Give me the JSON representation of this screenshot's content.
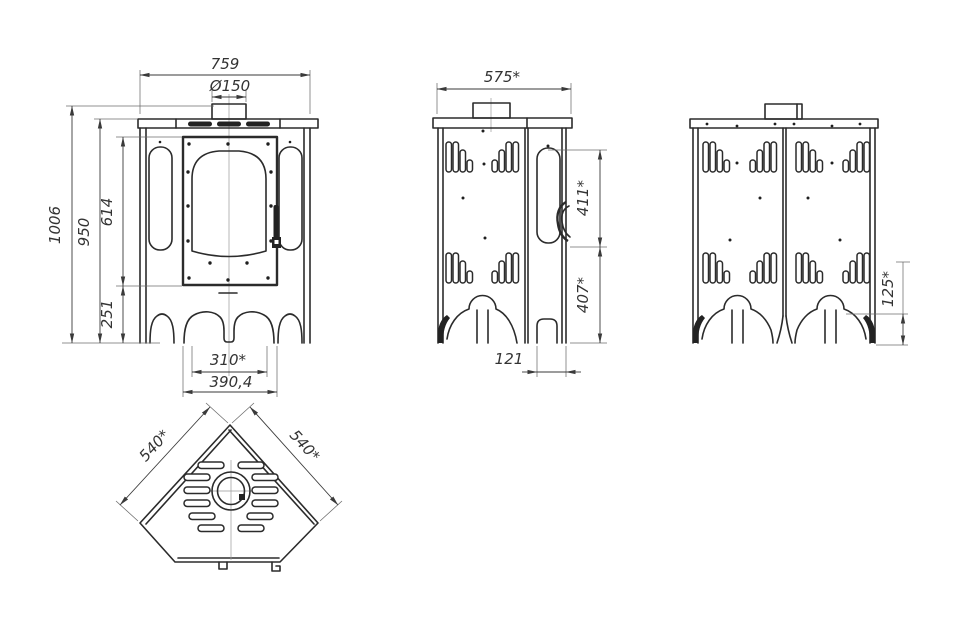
{
  "colors": {
    "background": "#ffffff",
    "line": "#2b2b2b",
    "thin_line": "#6b6b6b",
    "label": "#333333"
  },
  "views": {
    "front": {
      "dims": {
        "width": "759",
        "flue": "Ø150",
        "total_height": "1006",
        "body_height": "950",
        "door_zone": "614",
        "leg_zone": "251",
        "arch_width": "310*",
        "base_width": "390,4"
      }
    },
    "side": {
      "dims": {
        "depth": "575*",
        "upper": "411*",
        "lower": "407*",
        "foot": "121"
      }
    },
    "back": {
      "dims": {
        "leg": "125*"
      }
    },
    "top": {
      "dims": {
        "left": "540*",
        "right": "540*"
      }
    }
  }
}
